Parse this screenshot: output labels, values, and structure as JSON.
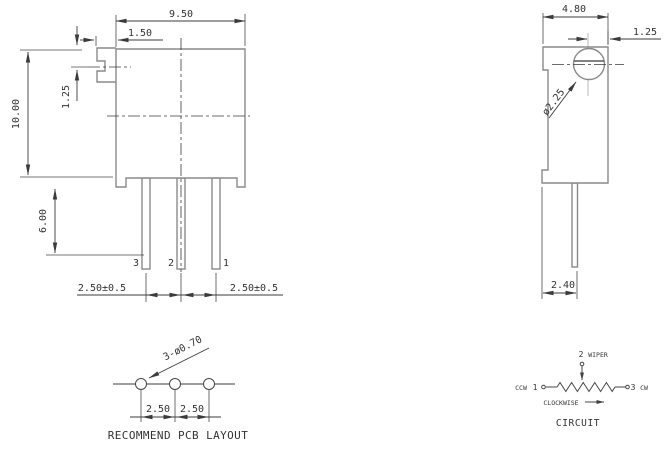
{
  "front": {
    "width": "9.50",
    "screw_tab_offset": "1.50",
    "slot_center_offset": "1.25",
    "height": "10.00",
    "pin_length": "6.00",
    "pin3": "3",
    "pin2": "2",
    "pin1": "1",
    "pitch_left": "2.50±0.5",
    "pitch_right": "2.50±0.5"
  },
  "side": {
    "depth": "4.80",
    "screw_edge_offset": "1.25",
    "screw_diameter": "ø2.25",
    "pin_offset": "2.40"
  },
  "pcb": {
    "hole_callout": "3-ø0.70",
    "pitch1": "2.50",
    "pitch2": "2.50",
    "caption": "RECOMMEND PCB LAYOUT"
  },
  "circuit": {
    "wiper_pin": "2",
    "wiper_label": "WIPER",
    "ccw_label": "CCW",
    "pin1": "1",
    "pin3": "3",
    "cw_label": "CW",
    "clockwise_label": "CLOCKWISE",
    "caption": "CIRCUIT"
  },
  "colors": {
    "object_line": "#8a8a8a",
    "dimension_line": "#3b3b3b",
    "text": "#333333",
    "background": "#ffffff"
  }
}
